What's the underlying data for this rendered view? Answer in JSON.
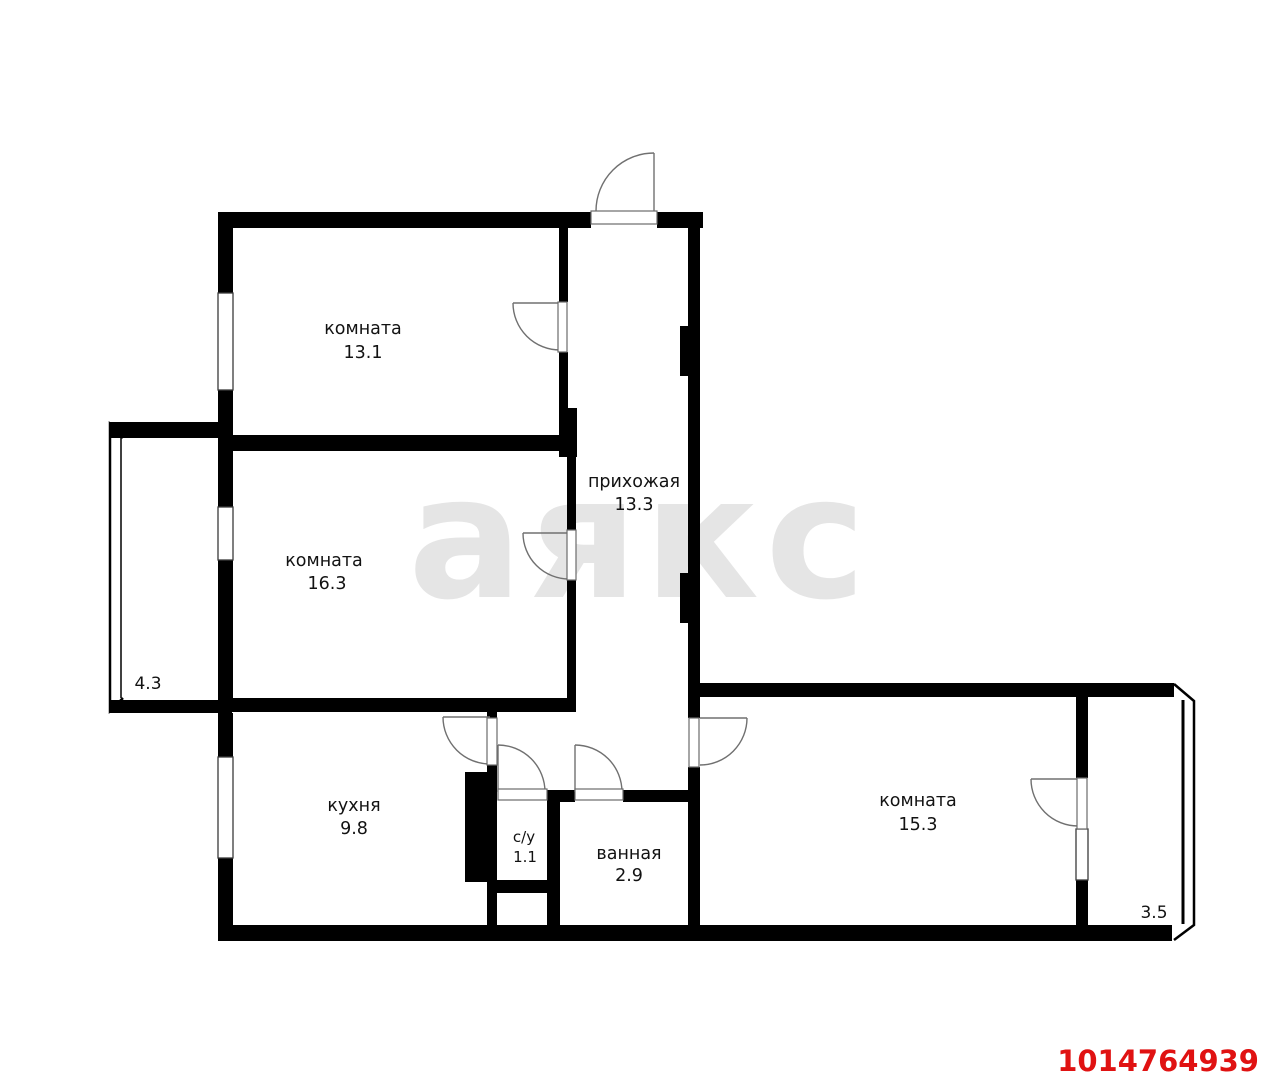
{
  "floorplan": {
    "watermark_text": "аякс",
    "listing_id": "1014764939",
    "rooms": [
      {
        "name": "комната",
        "area": "13.1"
      },
      {
        "name": "комната",
        "area": "16.3"
      },
      {
        "name": "прихожая",
        "area": "13.3"
      },
      {
        "name": "кухня",
        "area": "9.8"
      },
      {
        "name": "с/у",
        "area": "1.1"
      },
      {
        "name": "ванная",
        "area": "2.9"
      },
      {
        "name": "комната",
        "area": "15.3"
      }
    ],
    "balconies": [
      {
        "area": "4.3"
      },
      {
        "area": "3.5"
      }
    ],
    "colors": {
      "wall": "#000000",
      "background": "#ffffff",
      "watermark_gray": "#e5e5e5",
      "accent_red": "#e01212",
      "label_dark": "#121212"
    }
  }
}
